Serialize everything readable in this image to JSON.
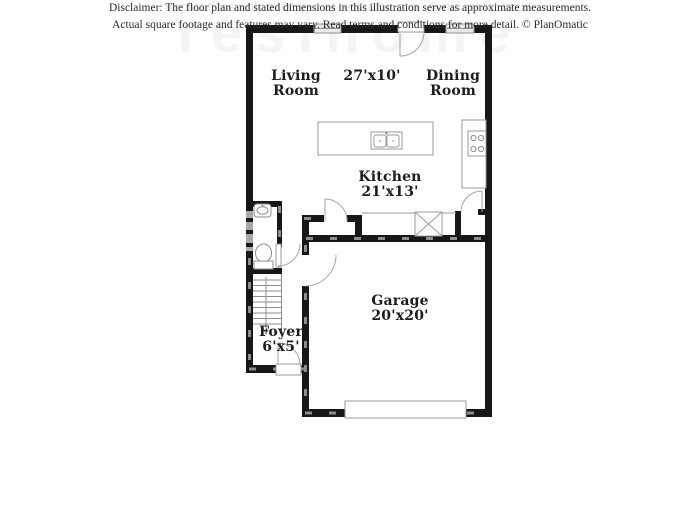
{
  "floor_plan": {
    "rooms": {
      "living_room": {
        "name_line1": "Living",
        "name_line2": "Room"
      },
      "living_dining_dimensions": "27'x10'",
      "dining_room": {
        "name_line1": "Dining",
        "name_line2": "Room"
      },
      "kitchen": {
        "name": "Kitchen",
        "dimensions": "21'x13'"
      },
      "garage": {
        "name": "Garage",
        "dimensions": "20'x20'"
      },
      "foyer": {
        "name": "Foyer",
        "dimensions": "6'x5'"
      }
    },
    "fixtures": [
      "kitchen-island-with-double-sink",
      "counter-with-cooktop",
      "powder-room-sink",
      "toilet",
      "staircase",
      "utility-closet-x",
      "garage-door",
      "entry-door",
      "windows"
    ]
  },
  "watermarks": {
    "center_small": "Applications only accepted at resihome.com. Avoid rental fraud.",
    "large_background": "resihome"
  },
  "disclaimer": {
    "line1": "Disclaimer: The floor plan and stated dimensions in this illustration serve as approximate measurements.",
    "line2": "Actual square footage and features may vary. Read terms and conditions for more detail. © PlanOmatic"
  },
  "colors": {
    "wall": "#171717",
    "wall_hatch": "#8d8d8d",
    "fixture_outline": "#8f8f8f",
    "window_fill": "#e9e9e9",
    "label_text": "#1c1c1c",
    "watermark_text": "#e2e2e2",
    "disclaimer_text": "#2b2b2b"
  }
}
